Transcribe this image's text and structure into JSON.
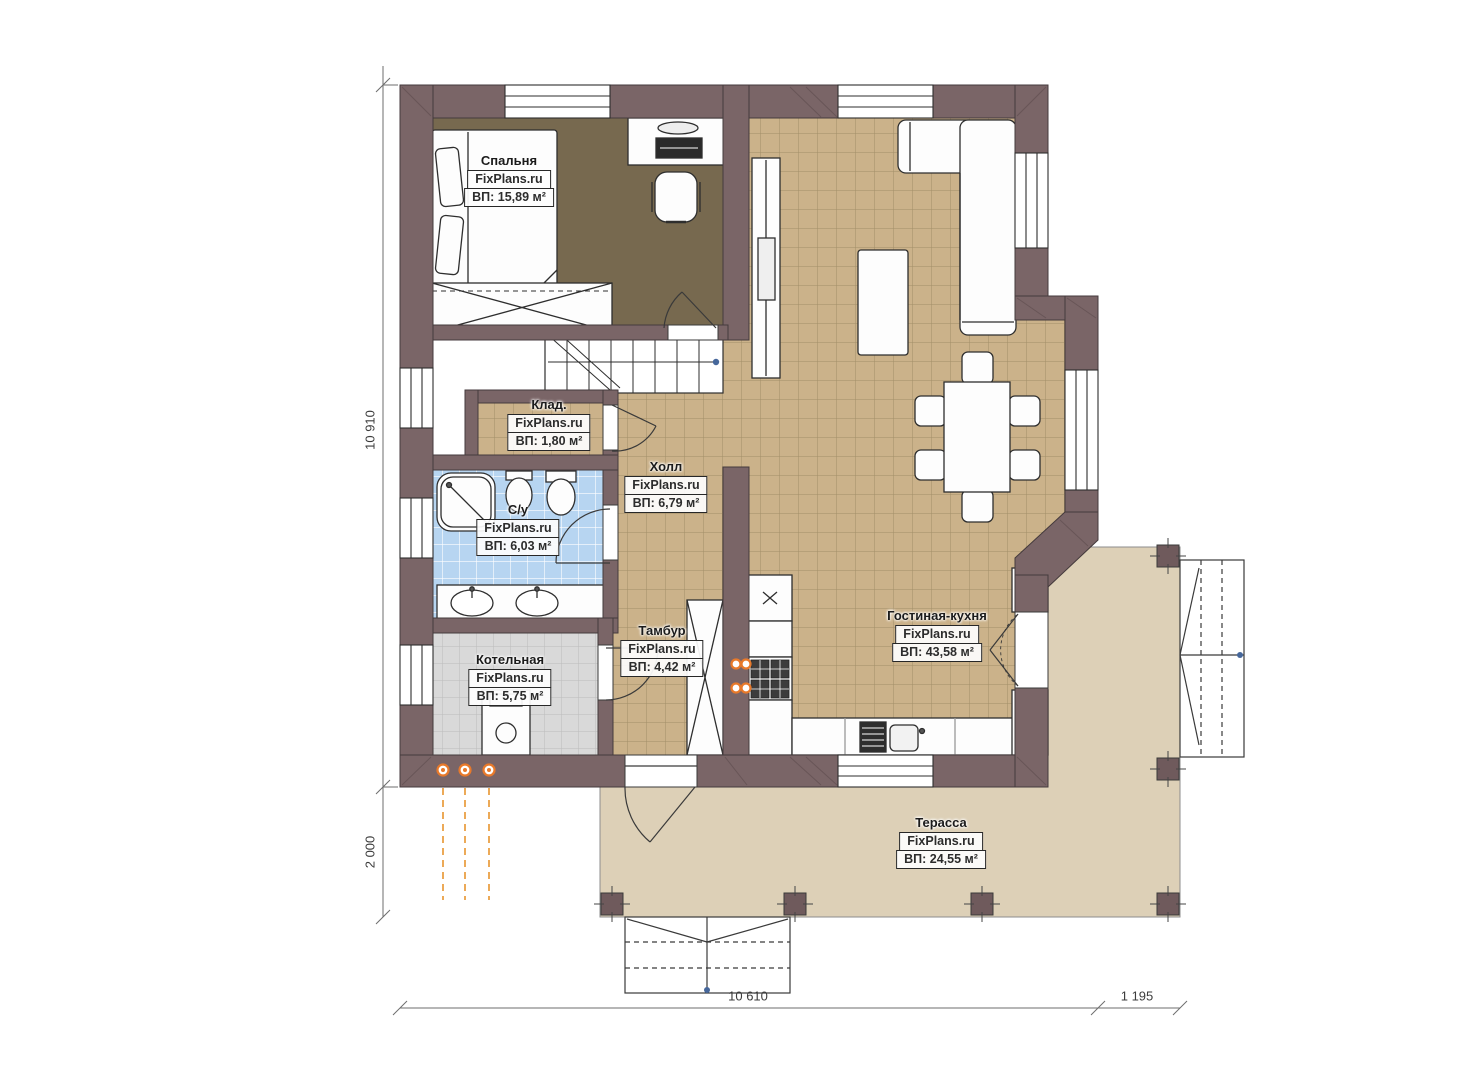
{
  "site": "FixPlans.ru",
  "rooms": [
    {
      "key": "bedroom",
      "name": "Спальня",
      "watermark": "FixPlans.ru",
      "area": "ВП: 15,89 м²"
    },
    {
      "key": "storage",
      "name": "Клад.",
      "watermark": "FixPlans.ru",
      "area": "ВП: 1,80 м²"
    },
    {
      "key": "bathroom",
      "name": "С/у",
      "watermark": "FixPlans.ru",
      "area": "ВП: 6,03 м²"
    },
    {
      "key": "hall",
      "name": "Холл",
      "watermark": "FixPlans.ru",
      "area": "ВП: 6,79 м²"
    },
    {
      "key": "boiler",
      "name": "Котельная",
      "watermark": "FixPlans.ru",
      "area": "ВП: 5,75 м²"
    },
    {
      "key": "vestibule",
      "name": "Тамбур",
      "watermark": "FixPlans.ru",
      "area": "ВП: 4,42 м²"
    },
    {
      "key": "living-kitchen",
      "name": "Гостиная-кухня",
      "watermark": "FixPlans.ru",
      "area": "ВП: 43,58 м²"
    },
    {
      "key": "terrace",
      "name": "Терасса",
      "watermark": "FixPlans.ru",
      "area": "ВП: 24,55 м²"
    }
  ],
  "dimensions": {
    "left_height": "10 910",
    "left_terrace": "2 000",
    "bottom_width": "10 610",
    "bottom_steps": "1 195"
  },
  "colors": {
    "wall": "#7a6567",
    "floor_tile_tan": "#cbb28a",
    "floor_grout_tan": "#a28e68",
    "floor_bedroom": "#77694f",
    "floor_tile_blue": "#b7d5f1",
    "floor_tile_gray": "#d9d9d9",
    "terrace": "#ddd0b7",
    "radiator_orange": "#e8792a",
    "dimension_gray": "#6e6e6e"
  }
}
